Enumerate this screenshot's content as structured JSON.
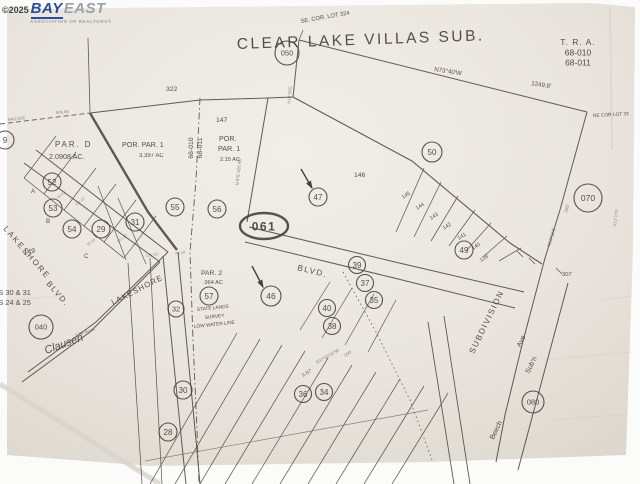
{
  "watermark": {
    "copyright": "©2025",
    "brand_bay": "BAY",
    "brand_east": "EAST",
    "tagline": "ASSOCIATION OF REALTORS®",
    "bay_color": "#2a4d9b",
    "east_color": "#9ba1a9"
  },
  "map": {
    "ink_color": "#45413b",
    "paper_color": "#eae6df",
    "title": "CLEAR LAKE VILLAS SUB.",
    "tra": {
      "heading": "T. R. A.",
      "codes": [
        "68-010",
        "68-011"
      ]
    },
    "corner_notes": {
      "se": "SE. COR. LOT 324",
      "ne": "NE COR LOT 33"
    },
    "parcels": [
      {
        "name": "PAR. D",
        "area": "2.0908 AC."
      },
      {
        "name": "POR. PAR. 1",
        "area": "3.397 AC"
      },
      {
        "name": "POR. PAR. 1",
        "area": "2.15 AC"
      },
      {
        "name": "PAR. 2",
        "area": ".964 AC"
      }
    ],
    "streets": [
      "LAKESHORE BLVD.",
      "LAKESHORE",
      "BLVD.",
      "Beech",
      "Ave",
      "Sub'n",
      "SUBDIVISION",
      "Clausen"
    ],
    "labels": [
      {
        "t": "CLEAR LAKE VILLAS SUB.",
        "x": 237,
        "y": 49,
        "s": 15.5,
        "r": -2,
        "ls": 2.5,
        "n": "map-title"
      },
      {
        "t": "SE. COR. LOT 324",
        "x": 301,
        "y": 23,
        "s": 5.8,
        "r": -10
      },
      {
        "t": "N73°40'W",
        "x": 434,
        "y": 71,
        "s": 6.2,
        "r": 9
      },
      {
        "t": "1249.8'",
        "x": 531,
        "y": 85,
        "s": 6.2,
        "r": 9
      },
      {
        "t": "NE COR LOT 33",
        "x": 593,
        "y": 117,
        "s": 4.8,
        "r": -3
      },
      {
        "t": "T. R. A.",
        "x": 578,
        "y": 45,
        "s": 8.5,
        "a": "m",
        "ls": 1,
        "n": "tra-heading"
      },
      {
        "t": "68-010",
        "x": 578,
        "y": 55.5,
        "s": 8.5,
        "a": "m",
        "n": "tra-code-1"
      },
      {
        "t": "68-011",
        "x": 578,
        "y": 65.5,
        "s": 8.5,
        "a": "m",
        "n": "tra-code-2"
      },
      {
        "t": "322",
        "x": 166,
        "y": 91,
        "s": 6.8
      },
      {
        "t": "147",
        "x": 216,
        "y": 122,
        "s": 6.8
      },
      {
        "t": "PAR.  D",
        "x": 55,
        "y": 147,
        "s": 7.8,
        "ls": 2
      },
      {
        "t": "2.0908 AC.",
        "x": 49,
        "y": 159,
        "s": 7.2
      },
      {
        "t": "POR. PAR. 1",
        "x": 122,
        "y": 147,
        "s": 7.2
      },
      {
        "t": "3.397 AC",
        "x": 139,
        "y": 157,
        "s": 6
      },
      {
        "t": "POR.",
        "x": 219,
        "y": 141,
        "s": 7.2
      },
      {
        "t": "PAR. 1",
        "x": 218,
        "y": 151,
        "s": 7.2
      },
      {
        "t": "2.15 AC",
        "x": 220,
        "y": 161,
        "s": 5.6
      },
      {
        "t": "68-010",
        "x": 193,
        "y": 148,
        "s": 6.8,
        "r": -90,
        "a": "m"
      },
      {
        "t": "68-011",
        "x": 202,
        "y": 148,
        "s": 6.8,
        "r": -90,
        "a": "m"
      },
      {
        "t": "146",
        "x": 354,
        "y": 177,
        "s": 6.8
      },
      {
        "t": "145",
        "x": 403,
        "y": 199,
        "s": 5.4,
        "r": -33
      },
      {
        "t": "144",
        "x": 417,
        "y": 210,
        "s": 5.4,
        "r": -33
      },
      {
        "t": "143",
        "x": 431,
        "y": 220,
        "s": 5.4,
        "r": -33
      },
      {
        "t": "142",
        "x": 444,
        "y": 230,
        "s": 5.4,
        "r": -33
      },
      {
        "t": "141",
        "x": 459,
        "y": 240,
        "s": 5.4,
        "r": -33
      },
      {
        "t": "140",
        "x": 473,
        "y": 250,
        "s": 5.4,
        "r": -33
      },
      {
        "t": "139",
        "x": 481,
        "y": 262,
        "s": 5.4,
        "r": -33
      },
      {
        "t": "307",
        "x": 562,
        "y": 276,
        "s": 5.8
      },
      {
        "t": "280'",
        "x": 567,
        "y": 213,
        "s": 4.6,
        "r": -73,
        "o": 0.6
      },
      {
        "t": "N13°15'E",
        "x": 550,
        "y": 247,
        "s": 4.6,
        "r": -73,
        "o": 0.6
      },
      {
        "t": "SUBDIVISION",
        "x": 489,
        "y": 323,
        "s": 8.2,
        "r": -64,
        "ls": 1.5,
        "a": "m"
      },
      {
        "t": "Ave",
        "x": 523,
        "y": 342,
        "s": 7,
        "r": -64,
        "a": "m"
      },
      {
        "t": "Sub'n",
        "x": 533,
        "y": 366,
        "s": 7,
        "r": -64,
        "a": "m"
      },
      {
        "t": "Beech",
        "x": 498,
        "y": 431,
        "s": 7,
        "r": -64,
        "a": "m"
      },
      {
        "t": "BLVD.",
        "x": 297,
        "y": 270,
        "s": 8.2,
        "r": 14,
        "ls": 1.5
      },
      {
        "t": "LAKESHORE",
        "x": 113,
        "y": 305,
        "s": 7.8,
        "r": -27,
        "ls": 1
      },
      {
        "t": "LAKESHORE",
        "x": 3,
        "y": 229,
        "s": 8,
        "r": 49,
        "ls": 2
      },
      {
        "t": "BLVD.",
        "x": 46,
        "y": 284,
        "s": 8,
        "r": 49,
        "ls": 1.5
      },
      {
        "t": "PAR. 2",
        "x": 201,
        "y": 275,
        "s": 6.8
      },
      {
        "t": ".964 AC",
        "x": 203,
        "y": 284,
        "s": 5.6
      },
      {
        "t": "STATE LANDS",
        "x": 197,
        "y": 311,
        "s": 4.8,
        "r": -6
      },
      {
        "t": "SURVEY",
        "x": 205,
        "y": 319,
        "s": 4.8,
        "r": -6
      },
      {
        "t": "LOW WATER LINE",
        "x": 194,
        "y": 328,
        "s": 4.8,
        "r": -6
      },
      {
        "t": "149",
        "x": 24,
        "y": 255,
        "s": 7,
        "r": -12,
        "f": "h"
      },
      {
        "t": "LOTS 30 & 31",
        "x": -16,
        "y": 295,
        "s": 7.4,
        "n": "edge-note-lots-30-31"
      },
      {
        "t": "LOTS 24 & 25",
        "x": -16,
        "y": 305,
        "s": 7.4,
        "n": "edge-note-lots-24-25"
      },
      {
        "t": "Clausen",
        "x": 46,
        "y": 354,
        "s": 11,
        "r": -20,
        "f": "h",
        "n": "handwritten-clausen"
      },
      {
        "t": "7.56 Acres",
        "x": 76,
        "y": 337,
        "s": 4.4,
        "r": -20,
        "o": 0.65
      },
      {
        "t": "9.87'",
        "x": 303,
        "y": 377,
        "s": 5.2,
        "r": -30,
        "o": 0.75
      },
      {
        "t": "S37°05'10\"W",
        "x": 317,
        "y": 364,
        "s": 4.4,
        "r": -30,
        "o": 0.65
      },
      {
        "t": "150'",
        "x": 345,
        "y": 357,
        "s": 4.4,
        "r": -30,
        "o": 0.65
      },
      {
        "t": "N 8°E 526.48'",
        "x": 240,
        "y": 172,
        "s": 4.4,
        "r": -84,
        "a": "m",
        "o": 0.65
      },
      {
        "t": "N43°16'E",
        "x": 8,
        "y": 121,
        "s": 4.2,
        "r": -6,
        "o": 0.6
      },
      {
        "t": "506.66'",
        "x": 56,
        "y": 114,
        "s": 4.2,
        "r": -5,
        "o": 0.6
      },
      {
        "t": "N16°35'E",
        "x": 291,
        "y": 95,
        "s": 4.2,
        "r": -85,
        "a": "m",
        "o": 0.6
      },
      {
        "t": "N13°10'E",
        "x": 617,
        "y": 218,
        "s": 4.2,
        "r": -83,
        "a": "m",
        "o": 0.5
      },
      {
        "t": "A",
        "x": 31,
        "y": 193,
        "s": 6.2
      },
      {
        "t": "B",
        "x": 46,
        "y": 223,
        "s": 6.2
      },
      {
        "t": "C",
        "x": 84,
        "y": 258,
        "s": 6.2
      },
      {
        "t": "131.03'",
        "x": 146,
        "y": 257,
        "s": 4,
        "r": -8,
        "o": 0.55
      },
      {
        "t": "78.18'",
        "x": 175,
        "y": 255,
        "s": 4,
        "r": -8,
        "o": 0.55
      },
      {
        "t": "48.62'",
        "x": 58,
        "y": 199,
        "s": 3.8,
        "r": -38,
        "o": 0.5
      },
      {
        "t": "110.15'",
        "x": 76,
        "y": 206,
        "s": 3.8,
        "r": -38,
        "o": 0.5
      },
      {
        "t": "121.40'",
        "x": 118,
        "y": 243,
        "s": 3.8,
        "r": -38,
        "o": 0.5
      },
      {
        "t": "93.35'",
        "x": 88,
        "y": 246,
        "s": 3.8,
        "r": -38,
        "o": 0.5
      }
    ],
    "circles": [
      {
        "id": "050",
        "x": 287,
        "y": 53,
        "r": 12,
        "fs": 7.5,
        "k": "ref"
      },
      {
        "id": "061",
        "x": 264,
        "y": 226,
        "rx": 24,
        "ry": 13,
        "fs": 12,
        "k": "ref",
        "oval": true
      },
      {
        "id": "070",
        "x": 588,
        "y": 198,
        "r": 14,
        "fs": 8.5,
        "k": "ref"
      },
      {
        "id": "040",
        "x": 41,
        "y": 327,
        "r": 12,
        "fs": 7.5,
        "k": "ref"
      },
      {
        "id": "080",
        "x": 533,
        "y": 402,
        "r": 11,
        "fs": 7.5,
        "k": "ref"
      },
      {
        "id": "50",
        "x": 432,
        "y": 152,
        "r": 10,
        "fs": 8
      },
      {
        "id": "47",
        "x": 318,
        "y": 197,
        "r": 9,
        "fs": 8
      },
      {
        "id": "46",
        "x": 271,
        "y": 296,
        "r": 10,
        "fs": 8.5
      },
      {
        "id": "49",
        "x": 464,
        "y": 250,
        "r": 9,
        "fs": 8
      },
      {
        "id": "55",
        "x": 175,
        "y": 207,
        "r": 9,
        "fs": 8
      },
      {
        "id": "56",
        "x": 217,
        "y": 209,
        "r": 9,
        "fs": 8
      },
      {
        "id": "57",
        "x": 209,
        "y": 296,
        "r": 9,
        "fs": 8
      },
      {
        "id": "52",
        "x": 52,
        "y": 182,
        "r": 9,
        "fs": 8
      },
      {
        "id": "53",
        "x": 53,
        "y": 208,
        "r": 9,
        "fs": 8
      },
      {
        "id": "54",
        "x": 72,
        "y": 229,
        "r": 9,
        "fs": 8
      },
      {
        "id": "29",
        "x": 101,
        "y": 229,
        "r": 9,
        "fs": 8
      },
      {
        "id": "31",
        "x": 135,
        "y": 222,
        "r": 9,
        "fs": 8
      },
      {
        "id": "32",
        "x": 176,
        "y": 309,
        "r": 8,
        "fs": 7.5
      },
      {
        "id": "30",
        "x": 183,
        "y": 390,
        "r": 9,
        "fs": 8
      },
      {
        "id": "28",
        "x": 168,
        "y": 432,
        "r": 9,
        "fs": 8
      },
      {
        "id": "39",
        "x": 357,
        "y": 265,
        "r": 8.5,
        "fs": 8
      },
      {
        "id": "37",
        "x": 365,
        "y": 283,
        "r": 8.5,
        "fs": 8
      },
      {
        "id": "35",
        "x": 374,
        "y": 300,
        "r": 8.5,
        "fs": 8
      },
      {
        "id": "40",
        "x": 327,
        "y": 308,
        "r": 8.5,
        "fs": 8
      },
      {
        "id": "38",
        "x": 332,
        "y": 326,
        "r": 8.5,
        "fs": 8
      },
      {
        "id": "36",
        "x": 303,
        "y": 394,
        "r": 8.5,
        "fs": 8
      },
      {
        "id": "34",
        "x": 324,
        "y": 392,
        "r": 8.5,
        "fs": 8
      },
      {
        "id": "9",
        "x": 5,
        "y": 140,
        "r": 9,
        "fs": 8
      }
    ],
    "arrows": [
      {
        "x1": 301,
        "y1": 169,
        "x2": 312,
        "y2": 188,
        "n": "arrow-to-lot-47"
      },
      {
        "x1": 252,
        "y1": 266,
        "x2": 263,
        "y2": 287,
        "n": "arrow-to-lot-46"
      }
    ]
  }
}
